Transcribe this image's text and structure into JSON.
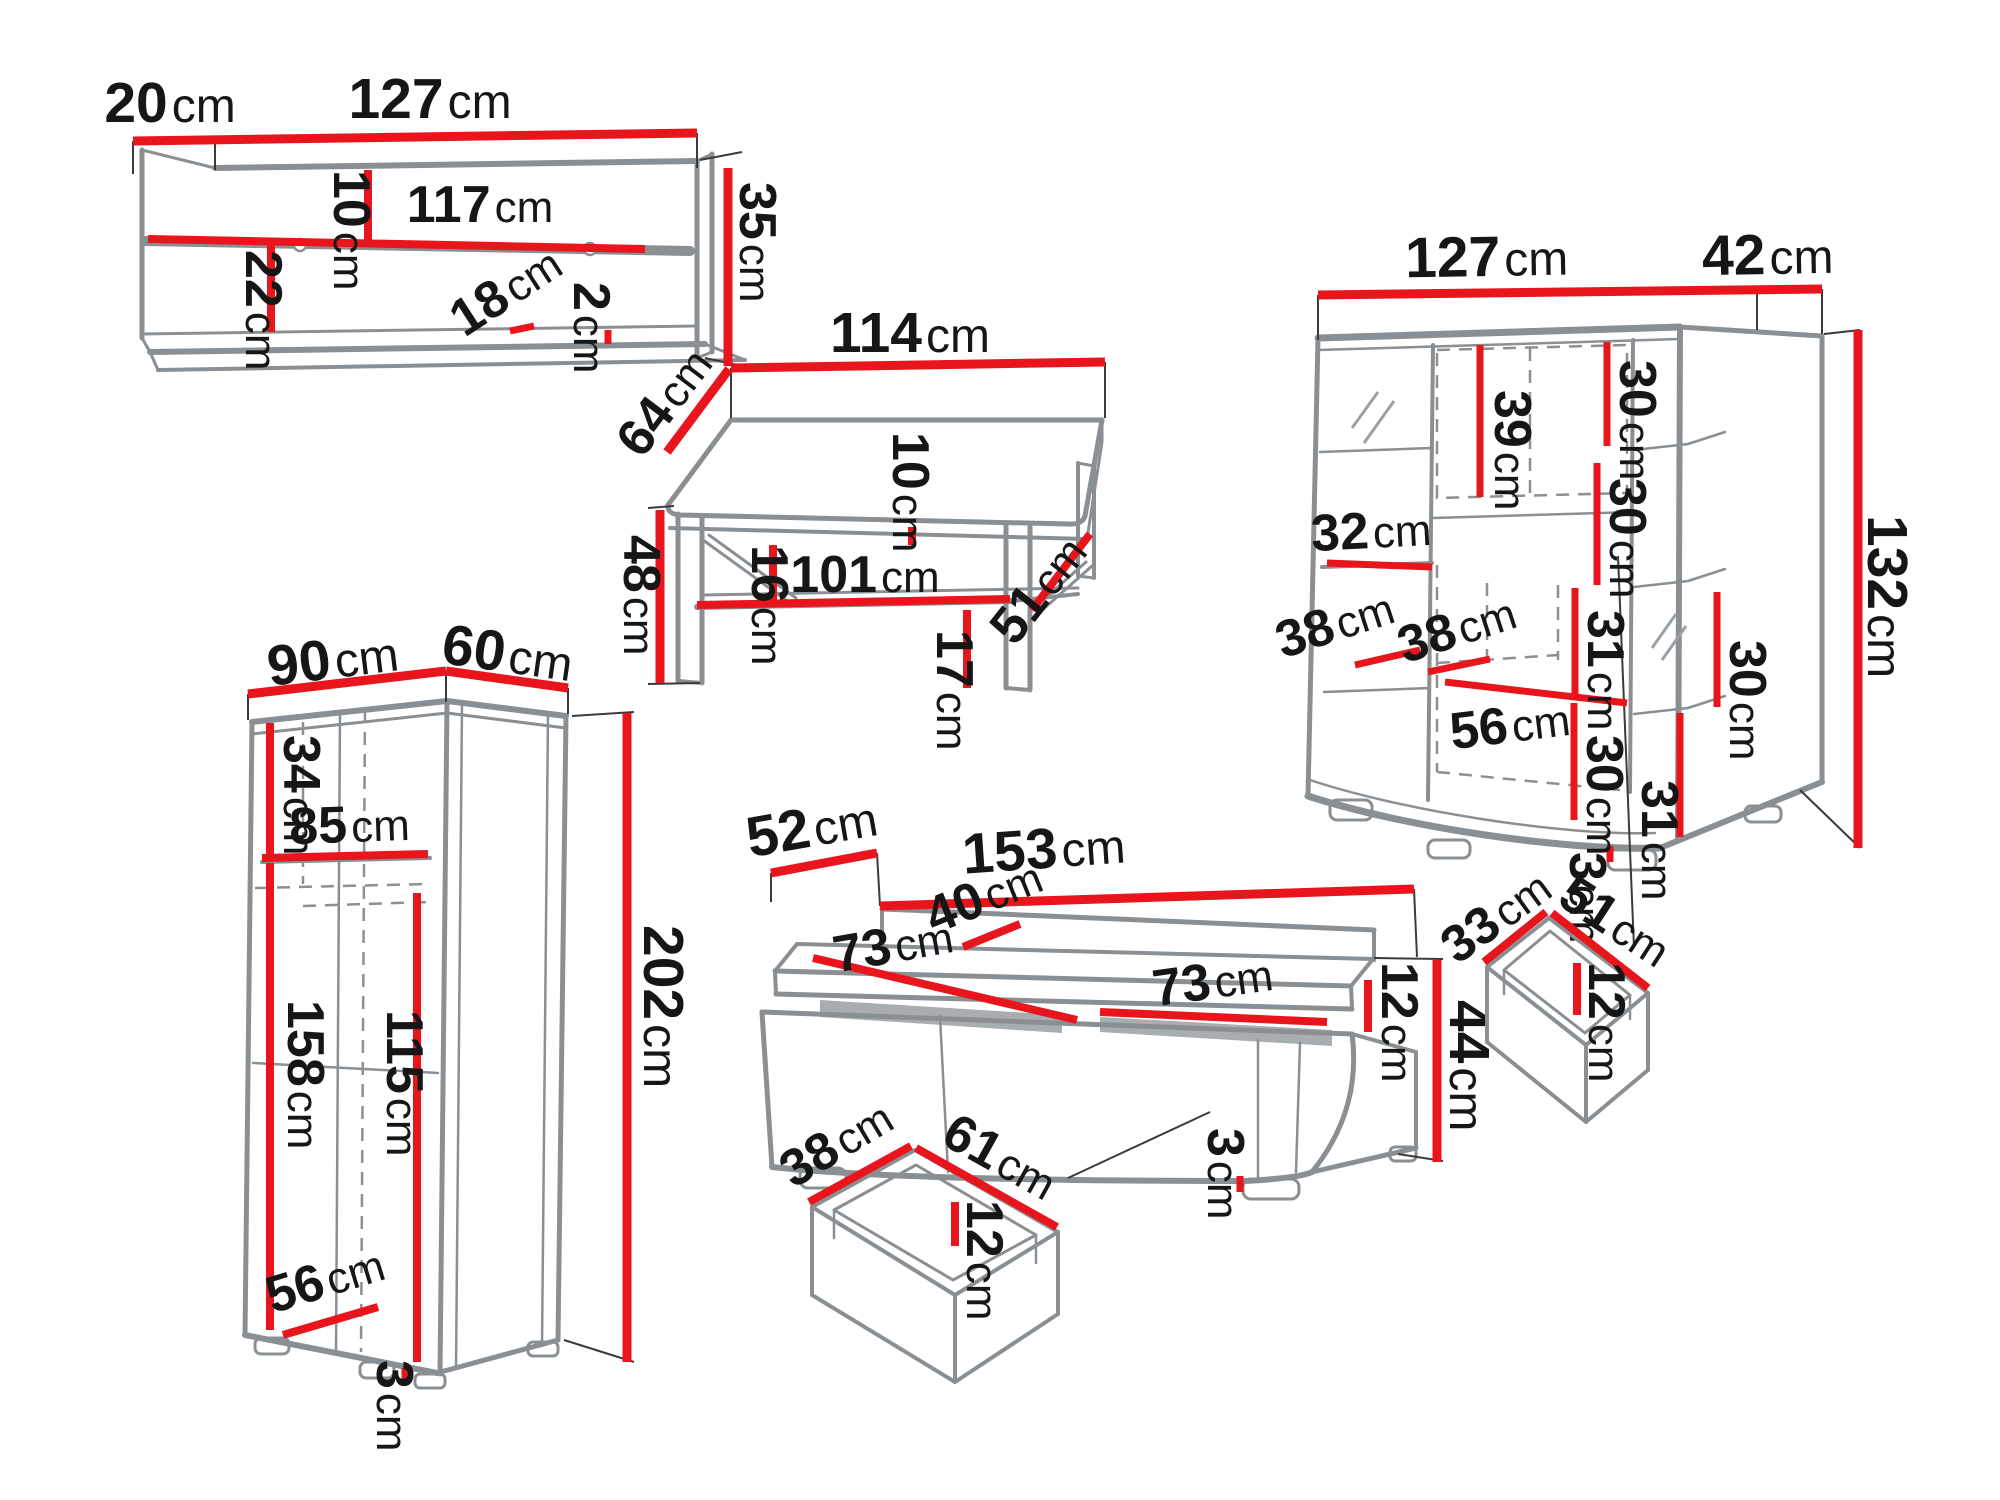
{
  "diagram": {
    "type": "furniture-dimension-diagram",
    "unit": "cm",
    "colors": {
      "dimension_line": "#e8151c",
      "outline": "#8a8f93",
      "construction_line": "#3a3a3a",
      "label_text": "#161616",
      "background": "#ffffff"
    },
    "pieces": {
      "wall_shelf": {
        "name": "wall shelf",
        "dims": {
          "depth": {
            "v": "20",
            "u": "cm"
          },
          "width": {
            "v": "127",
            "u": "cm"
          },
          "height": {
            "v": "35",
            "u": "cm"
          },
          "top_gap": {
            "v": "10",
            "u": "cm"
          },
          "inner_width": {
            "v": "117",
            "u": "cm"
          },
          "bottom_gap": {
            "v": "22",
            "u": "cm"
          },
          "shelf_depth": {
            "v": "18",
            "u": "cm"
          },
          "board_thickness": {
            "v": "2",
            "u": "cm"
          }
        }
      },
      "coffee_table": {
        "name": "coffee table",
        "dims": {
          "width": {
            "v": "114",
            "u": "cm"
          },
          "depth": {
            "v": "64",
            "u": "cm"
          },
          "height": {
            "v": "48",
            "u": "cm"
          },
          "shelf_gap": {
            "v": "16",
            "u": "cm"
          },
          "shelf_width": {
            "v": "101",
            "u": "cm"
          },
          "top_thickness": {
            "v": "10",
            "u": "cm"
          },
          "shelf_depth": {
            "v": "51",
            "u": "cm"
          },
          "floor_clearance": {
            "v": "17",
            "u": "cm"
          }
        }
      },
      "bookcase": {
        "name": "display bookcase",
        "dims": {
          "width": {
            "v": "127",
            "u": "cm"
          },
          "depth": {
            "v": "42",
            "u": "cm"
          },
          "height": {
            "v": "132",
            "u": "cm"
          },
          "niche_39": {
            "v": "39",
            "u": "cm"
          },
          "niche_30_a": {
            "v": "30",
            "u": "cm"
          },
          "niche_30_b": {
            "v": "30",
            "u": "cm"
          },
          "shelf_32": {
            "v": "32",
            "u": "cm"
          },
          "niche_31_a": {
            "v": "31",
            "u": "cm"
          },
          "niche_30_c": {
            "v": "30",
            "u": "cm"
          },
          "shelf_38_a": {
            "v": "38",
            "u": "cm"
          },
          "shelf_38_b": {
            "v": "38",
            "u": "cm"
          },
          "niche_56": {
            "v": "56",
            "u": "cm"
          },
          "niche_30_d": {
            "v": "30",
            "u": "cm"
          },
          "niche_31_b": {
            "v": "31",
            "u": "cm"
          },
          "feet_height": {
            "v": "3",
            "u": "cm"
          }
        }
      },
      "wardrobe": {
        "name": "wardrobe",
        "dims": {
          "width": {
            "v": "90",
            "u": "cm"
          },
          "depth": {
            "v": "60",
            "u": "cm"
          },
          "height": {
            "v": "202",
            "u": "cm"
          },
          "top_section": {
            "v": "34",
            "u": "cm"
          },
          "inner_width": {
            "v": "85",
            "u": "cm"
          },
          "door_height": {
            "v": "158",
            "u": "cm"
          },
          "inner_height": {
            "v": "115",
            "u": "cm"
          },
          "inner_depth": {
            "v": "56",
            "u": "cm"
          },
          "feet_height": {
            "v": "3",
            "u": "cm"
          }
        }
      },
      "tv_stand": {
        "name": "TV stand",
        "dims": {
          "depth": {
            "v": "52",
            "u": "cm"
          },
          "width": {
            "v": "153",
            "u": "cm"
          },
          "top_segment": {
            "v": "40",
            "u": "cm"
          },
          "niche_left": {
            "v": "73",
            "u": "cm"
          },
          "niche_right": {
            "v": "73",
            "u": "cm"
          },
          "riser_height": {
            "v": "12",
            "u": "cm"
          },
          "height": {
            "v": "44",
            "u": "cm"
          },
          "feet_height": {
            "v": "3",
            "u": "cm"
          }
        }
      },
      "drawer_tv": {
        "name": "TV stand drawer",
        "dims": {
          "depth": {
            "v": "38",
            "u": "cm"
          },
          "width": {
            "v": "61",
            "u": "cm"
          },
          "height": {
            "v": "12",
            "u": "cm"
          }
        }
      },
      "drawer_bookcase": {
        "name": "bookcase drawer",
        "dims": {
          "depth": {
            "v": "33",
            "u": "cm"
          },
          "width": {
            "v": "51",
            "u": "cm"
          },
          "height": {
            "v": "12",
            "u": "cm"
          }
        }
      }
    }
  }
}
